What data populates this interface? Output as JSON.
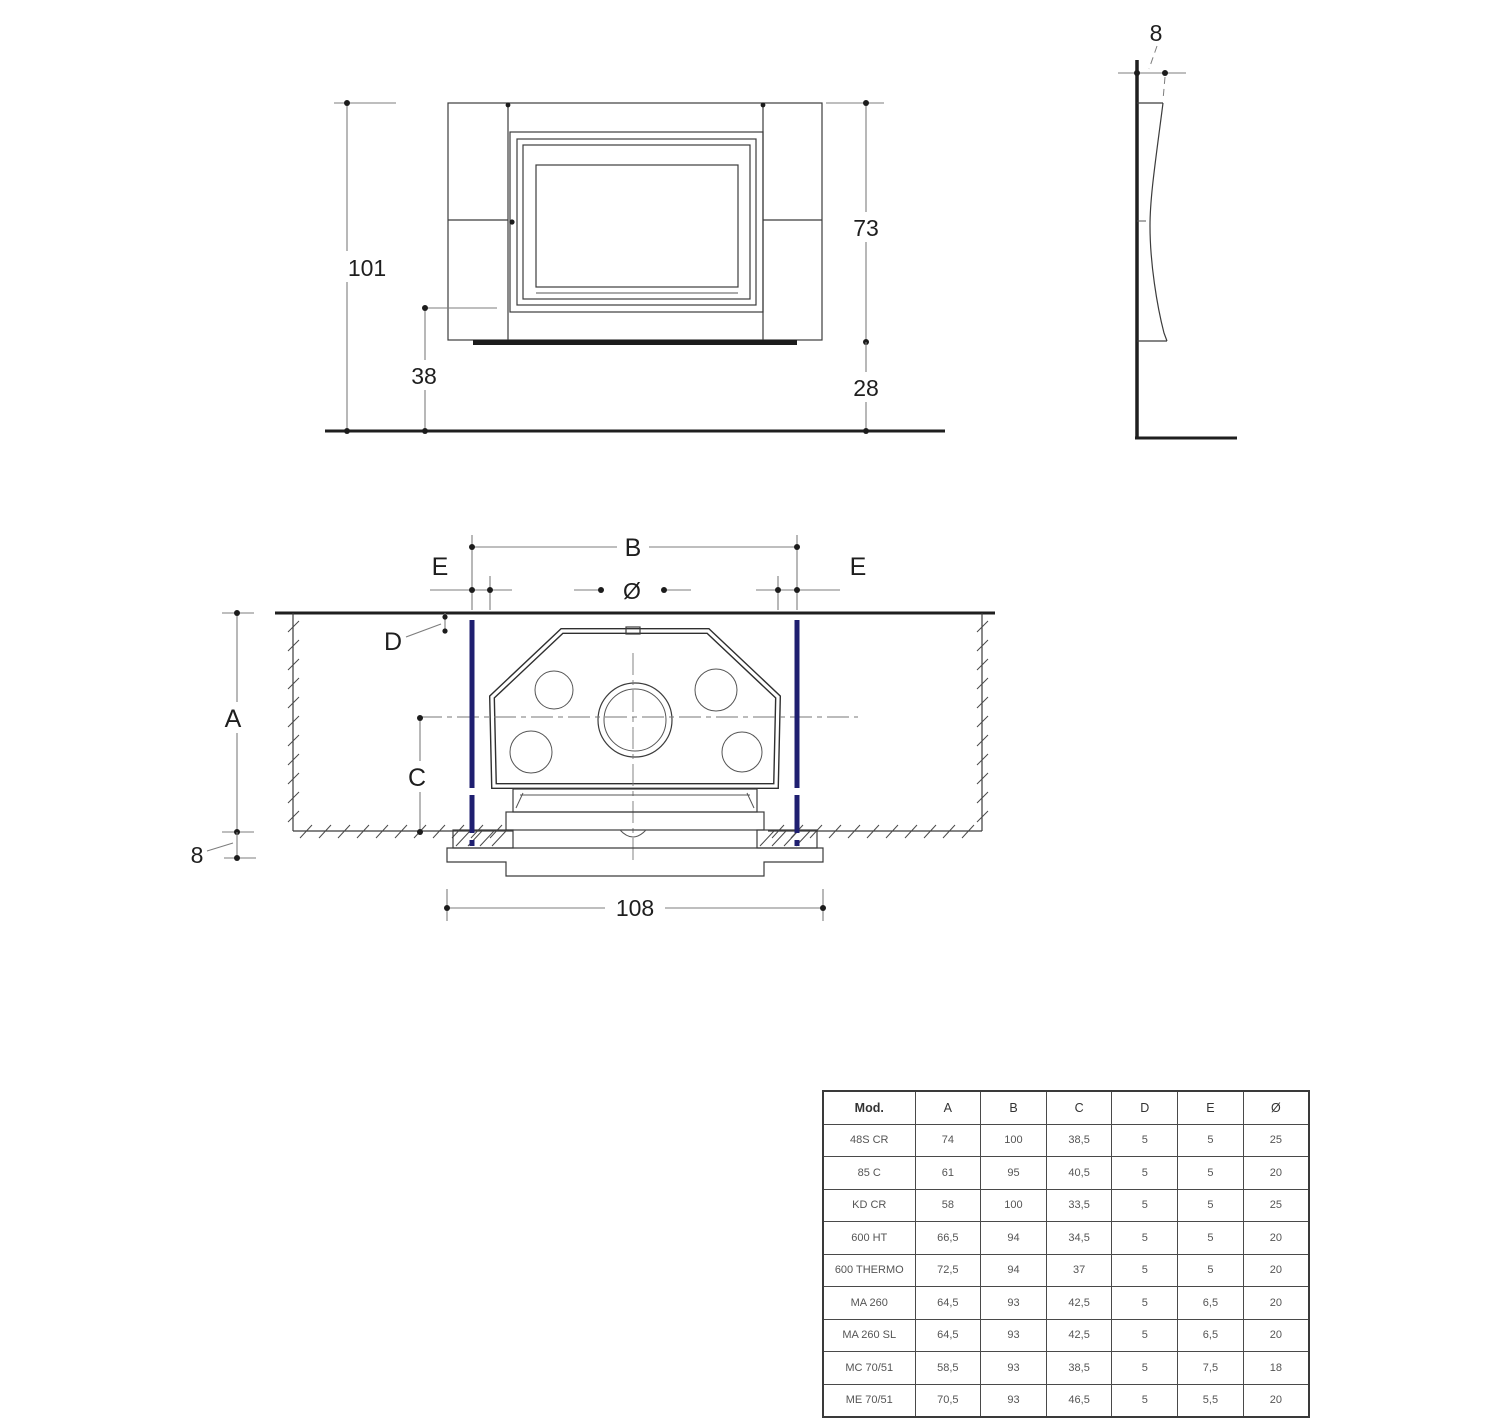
{
  "drawing": {
    "front_view": {
      "dim_total_height": "101",
      "dim_insert_height": "73",
      "dim_lower_height": "38",
      "dim_base_height": "28"
    },
    "side_view": {
      "dim_depth": "8"
    },
    "plan_view": {
      "dim_b": "B",
      "dim_e_left": "E",
      "dim_e_right": "E",
      "dim_diameter": "Ø",
      "dim_d": "D",
      "dim_a": "A",
      "dim_c": "C",
      "dim_wall_gap": "8",
      "dim_base_width": "108"
    }
  },
  "colors": {
    "flue_marker_blue": "#1f1f70",
    "line_dark": "#2f2f2f",
    "dim_gray": "#7d7d7d"
  },
  "table": {
    "headers": [
      "Mod.",
      "A",
      "B",
      "C",
      "D",
      "E",
      "Ø"
    ],
    "rows": [
      [
        "48S CR",
        "74",
        "100",
        "38,5",
        "5",
        "5",
        "25"
      ],
      [
        "85 C",
        "61",
        "95",
        "40,5",
        "5",
        "5",
        "20"
      ],
      [
        "KD CR",
        "58",
        "100",
        "33,5",
        "5",
        "5",
        "25"
      ],
      [
        "600 HT",
        "66,5",
        "94",
        "34,5",
        "5",
        "5",
        "20"
      ],
      [
        "600 THERMO",
        "72,5",
        "94",
        "37",
        "5",
        "5",
        "20"
      ],
      [
        "MA 260",
        "64,5",
        "93",
        "42,5",
        "5",
        "6,5",
        "20"
      ],
      [
        "MA 260 SL",
        "64,5",
        "93",
        "42,5",
        "5",
        "6,5",
        "20"
      ],
      [
        "MC 70/51",
        "58,5",
        "93",
        "38,5",
        "5",
        "7,5",
        "18"
      ],
      [
        "ME 70/51",
        "70,5",
        "93",
        "46,5",
        "5",
        "5,5",
        "20"
      ]
    ]
  }
}
